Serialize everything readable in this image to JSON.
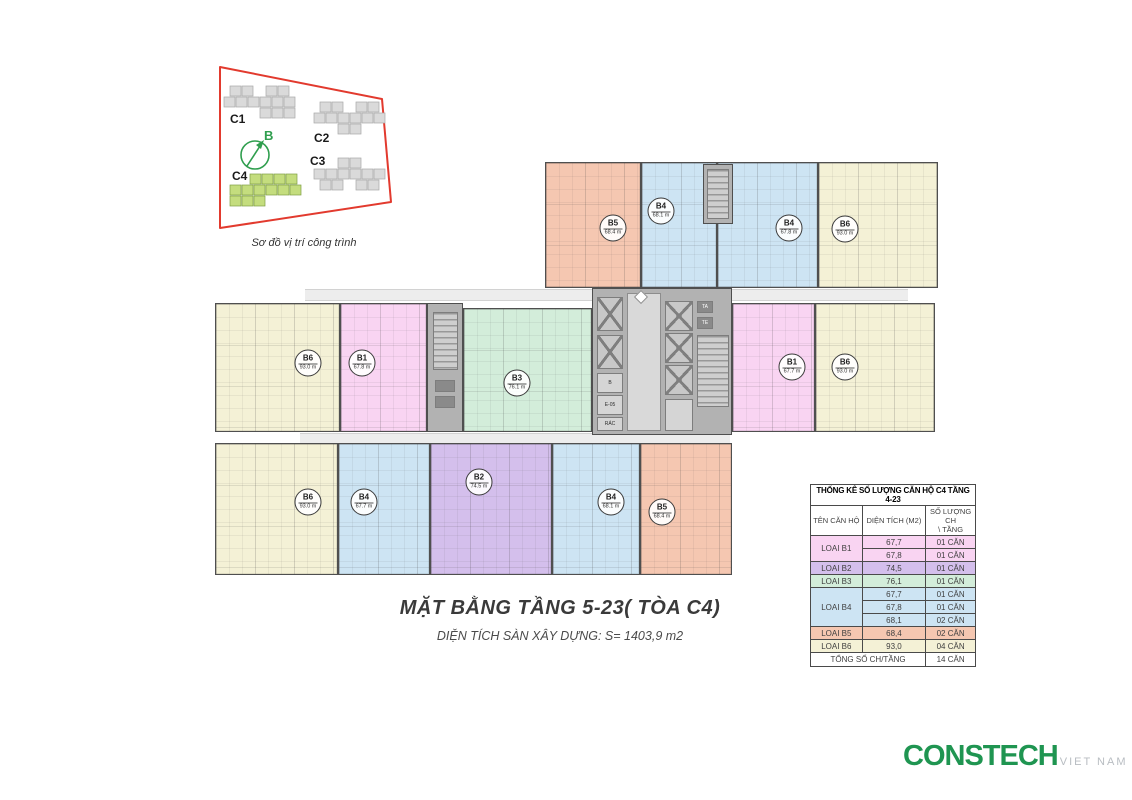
{
  "location_diagram": {
    "caption": "Sơ đồ vị trí công trình",
    "compass_label": "B",
    "accent_green": "#2f9e4e",
    "boundary_red": "#e23a2e",
    "buildings": [
      {
        "label": "C1",
        "highlight": false
      },
      {
        "label": "C2",
        "highlight": false
      },
      {
        "label": "C3",
        "highlight": false
      },
      {
        "label": "C4",
        "highlight": true
      }
    ]
  },
  "plan": {
    "palette": {
      "B1": "#f9d4f2",
      "B2": "#d4bfec",
      "B3": "#d3edda",
      "B4": "#cde4f3",
      "B5": "#f5c7b1",
      "B6": "#f4f1d6"
    },
    "bands": [
      [
        305,
        289,
        287,
        12
      ],
      [
        732,
        289,
        176,
        12
      ],
      [
        300,
        433,
        430,
        11
      ]
    ],
    "units": [
      {
        "id": "b5-top",
        "type": "B5",
        "code": "B5",
        "area": "68.4 m",
        "x": 545,
        "y": 162,
        "w": 96,
        "h": 126,
        "lx": 613,
        "ly": 228
      },
      {
        "id": "b4-top-left",
        "type": "B4",
        "code": "B4",
        "area": "68.1 m",
        "x": 641,
        "y": 162,
        "w": 76,
        "h": 126,
        "lx": 661,
        "ly": 211
      },
      {
        "id": "b4-top-right",
        "type": "B4",
        "code": "B4",
        "area": "67.8 m",
        "x": 717,
        "y": 162,
        "w": 101,
        "h": 126,
        "lx": 789,
        "ly": 228
      },
      {
        "id": "b6-top-right",
        "type": "B6",
        "code": "B6",
        "area": "93.0 m",
        "x": 818,
        "y": 162,
        "w": 120,
        "h": 126,
        "lx": 845,
        "ly": 229
      },
      {
        "id": "b6-mid-left",
        "type": "B6",
        "code": "B6",
        "area": "93.0 m",
        "x": 215,
        "y": 303,
        "w": 125,
        "h": 129,
        "lx": 308,
        "ly": 363
      },
      {
        "id": "b1-mid-left",
        "type": "B1",
        "code": "B1",
        "area": "67.8 m",
        "x": 340,
        "y": 303,
        "w": 87,
        "h": 129,
        "lx": 362,
        "ly": 363
      },
      {
        "id": "b3-mid",
        "type": "B3",
        "code": "B3",
        "area": "76.1 m",
        "x": 463,
        "y": 308,
        "w": 129,
        "h": 124,
        "lx": 517,
        "ly": 383
      },
      {
        "id": "b1-mid-right",
        "type": "B1",
        "code": "B1",
        "area": "67.7 m",
        "x": 732,
        "y": 303,
        "w": 83,
        "h": 129,
        "lx": 792,
        "ly": 367
      },
      {
        "id": "b6-mid-right",
        "type": "B6",
        "code": "B6",
        "area": "93.0 m",
        "x": 815,
        "y": 303,
        "w": 120,
        "h": 129,
        "lx": 845,
        "ly": 367
      },
      {
        "id": "b6-bottom-left",
        "type": "B6",
        "code": "B6",
        "area": "93.0 m",
        "x": 215,
        "y": 443,
        "w": 123,
        "h": 132,
        "lx": 308,
        "ly": 502
      },
      {
        "id": "b4-bottom-left",
        "type": "B4",
        "code": "B4",
        "area": "67.7 m",
        "x": 338,
        "y": 443,
        "w": 92,
        "h": 132,
        "lx": 364,
        "ly": 502
      },
      {
        "id": "b2-bottom",
        "type": "B2",
        "code": "B2",
        "area": "74.5 m",
        "x": 430,
        "y": 443,
        "w": 122,
        "h": 132,
        "lx": 479,
        "ly": 482
      },
      {
        "id": "b4-bottom-right",
        "type": "B4",
        "code": "B4",
        "area": "68.1 m",
        "x": 552,
        "y": 443,
        "w": 88,
        "h": 132,
        "lx": 611,
        "ly": 502
      },
      {
        "id": "b5-bottom",
        "type": "B5",
        "code": "B5",
        "area": "68.4 m",
        "x": 640,
        "y": 443,
        "w": 92,
        "h": 132,
        "lx": 662,
        "ly": 512
      }
    ],
    "core_labels": {
      "b": "B",
      "e05": "E-05",
      "rac": "RÁC",
      "ta": "TA",
      "te": "TE"
    }
  },
  "title_block": {
    "title": "MẶT BẰNG TẦNG 5-23( TÒA C4)",
    "subtitle": "DIỆN TÍCH SÀN XÂY DỰNG: S= 1403,9 m2"
  },
  "table": {
    "title": "THỐNG KÊ SỐ LƯỢNG CĂN HỘ C4 TẦNG 4-23",
    "headers": [
      "TÊN CĂN HỘ",
      "DIỆN TÍCH (M2)"
    ],
    "header3_line1": "SỐ LƯỢNG CH",
    "header3_line2": "\\ TẦNG",
    "groups": [
      {
        "label": "LOAI B1",
        "color": "#f9d4f2",
        "entries": [
          [
            "67,7",
            "01 CĂN"
          ],
          [
            "67,8",
            "01 CĂN"
          ]
        ]
      },
      {
        "label": "LOAI B2",
        "color": "#d4bfec",
        "entries": [
          [
            "74,5",
            "01 CĂN"
          ]
        ]
      },
      {
        "label": "LOAI B3",
        "color": "#d3edda",
        "entries": [
          [
            "76,1",
            "01 CĂN"
          ]
        ]
      },
      {
        "label": "LOAI B4",
        "color": "#cde4f3",
        "entries": [
          [
            "67,7",
            "01 CĂN"
          ],
          [
            "67,8",
            "01 CĂN"
          ],
          [
            "68,1",
            "02 CĂN"
          ]
        ]
      },
      {
        "label": "LOAI B5",
        "color": "#f5c7b1",
        "entries": [
          [
            "68,4",
            "02 CĂN"
          ]
        ]
      },
      {
        "label": "LOAI B6",
        "color": "#f4f1d6",
        "entries": [
          [
            "93,0",
            "04 CĂN"
          ]
        ]
      }
    ],
    "footer": {
      "label": "TỔNG SỐ CH/TẦNG",
      "value": "14 CĂN"
    }
  },
  "logo": {
    "name": "CONSTECH",
    "suffix": "VIET NAM"
  }
}
